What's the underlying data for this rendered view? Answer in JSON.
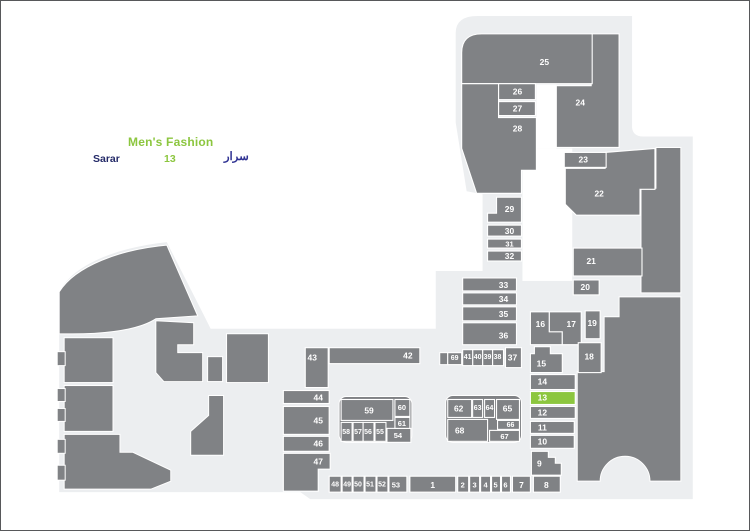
{
  "legend": {
    "category_label": "Men's Fashion",
    "store_name_en": "Sarar",
    "unit_number": "13",
    "store_name_ar": "سرار"
  },
  "map": {
    "highlighted_unit": "13",
    "units": [
      {
        "label": "1"
      },
      {
        "label": "2"
      },
      {
        "label": "3"
      },
      {
        "label": "4"
      },
      {
        "label": "5"
      },
      {
        "label": "6"
      },
      {
        "label": "7"
      },
      {
        "label": "8"
      },
      {
        "label": "9"
      },
      {
        "label": "10"
      },
      {
        "label": "11"
      },
      {
        "label": "12"
      },
      {
        "label": "13"
      },
      {
        "label": "14"
      },
      {
        "label": "15"
      },
      {
        "label": "16"
      },
      {
        "label": "17"
      },
      {
        "label": "18"
      },
      {
        "label": "19"
      },
      {
        "label": "20"
      },
      {
        "label": "21"
      },
      {
        "label": "22"
      },
      {
        "label": "23"
      },
      {
        "label": "24"
      },
      {
        "label": "25"
      },
      {
        "label": "26"
      },
      {
        "label": "27"
      },
      {
        "label": "28"
      },
      {
        "label": "29"
      },
      {
        "label": "30"
      },
      {
        "label": "31"
      },
      {
        "label": "32"
      },
      {
        "label": "33"
      },
      {
        "label": "34"
      },
      {
        "label": "35"
      },
      {
        "label": "36"
      },
      {
        "label": "37"
      },
      {
        "label": "38"
      },
      {
        "label": "39"
      },
      {
        "label": "40"
      },
      {
        "label": "41"
      },
      {
        "label": "42"
      },
      {
        "label": "43"
      },
      {
        "label": "44"
      },
      {
        "label": "45"
      },
      {
        "label": "46"
      },
      {
        "label": "47"
      },
      {
        "label": "48"
      },
      {
        "label": "49"
      },
      {
        "label": "50"
      },
      {
        "label": "51"
      },
      {
        "label": "52"
      },
      {
        "label": "53"
      },
      {
        "label": "54"
      },
      {
        "label": "55"
      },
      {
        "label": "56"
      },
      {
        "label": "57"
      },
      {
        "label": "58"
      },
      {
        "label": "59"
      },
      {
        "label": "60"
      },
      {
        "label": "61"
      },
      {
        "label": "62"
      },
      {
        "label": "63"
      },
      {
        "label": "64"
      },
      {
        "label": "65"
      },
      {
        "label": "66"
      },
      {
        "label": "67"
      },
      {
        "label": "68"
      },
      {
        "label": "69"
      }
    ]
  },
  "colors": {
    "unit_fill": "#808285",
    "floor_fill": "#ECEEF0",
    "highlight_green": "#8CC63F",
    "legend_navy": "#242A68",
    "arabic_navy": "#2E3192",
    "unit_label_color": "#FFFFFF",
    "frame_border": "#57585A"
  }
}
